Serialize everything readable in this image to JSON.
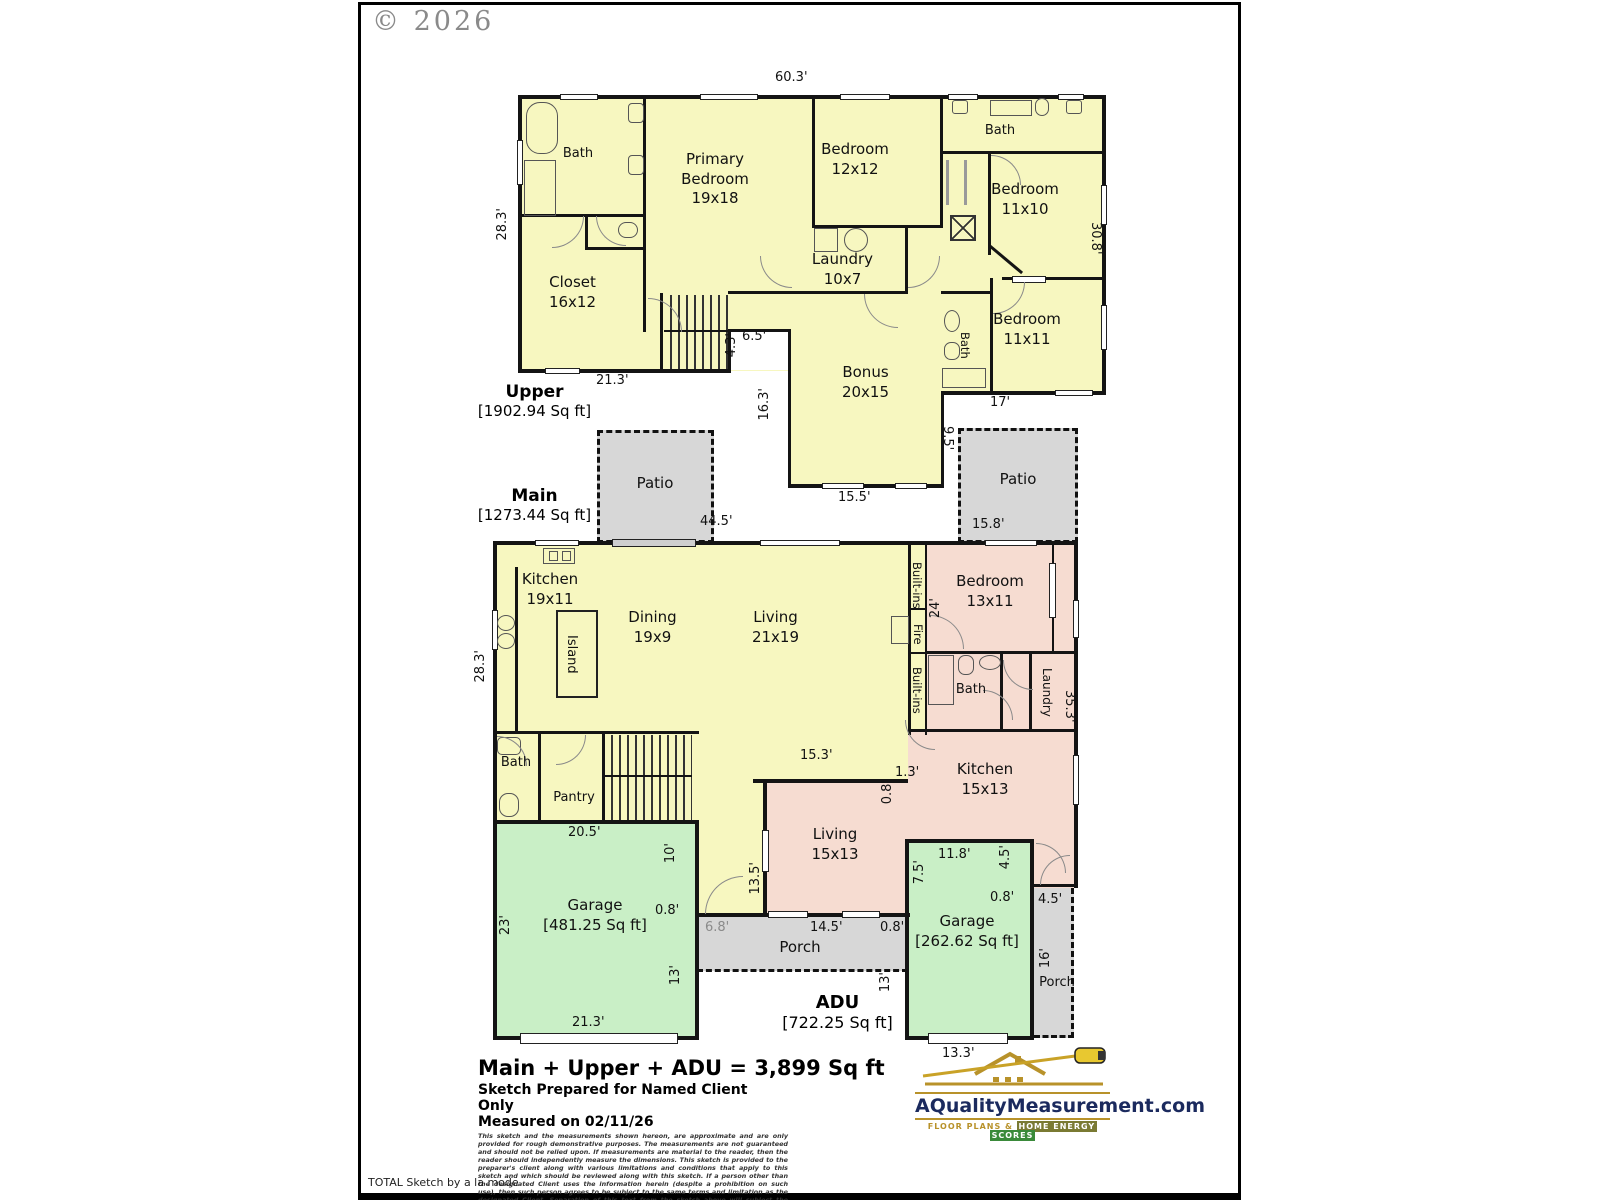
{
  "copyright": "© 2026",
  "footer_note": "TOTAL Sketch by a la mode",
  "floors": {
    "upper": {
      "name": "Upper",
      "sqft": "[1902.94 Sq ft]"
    },
    "main": {
      "name": "Main",
      "sqft": "[1273.44 Sq ft]"
    },
    "adu": {
      "name": "ADU",
      "sqft": "[722.25 Sq ft]"
    }
  },
  "summary": {
    "total": "Main + Upper + ADU = 3,899 Sq ft",
    "prepared": "Sketch Prepared for Named Client Only",
    "measured": "Measured on 02/11/26",
    "disclaimer": "This sketch and the measurements shown hereon, are approximate and are only provided for rough demonstrative purposes. The measurements are not guaranteed and should not be relied upon.  If measurements are material to the reader, then the reader should independently measure the dimensions.  This sketch is provided to the preparer's client along with various limitations and conditions that apply to this sketch and which should be reviewed along with this sketch.  If a person other than the designated Client uses the information herein (despite a prohibition on such use), then such person agrees to be subject to the same terms and limitation as the designated Client.  Separation of this text from the sketch above will subject the separating party to liability."
  },
  "branding": {
    "site": "AQualityMeasurement.com",
    "tagline_prefix": "Floor Plans &",
    "tagline_box1": "Home Energy",
    "tagline_box2": "Scores"
  },
  "rooms": {
    "upper_bath": "Bath",
    "primary_bedroom": "Primary\nBedroom\n19x18",
    "bedroom_12x12": "Bedroom\n12x12",
    "upper_bath2": "Bath",
    "bedroom_11x10": "Bedroom\n11x10",
    "closet": "Closet\n16x12",
    "laundry_upper": "Laundry\n10x7",
    "bedroom_11x11": "Bedroom\n11x11",
    "upper_bath3": "Bath",
    "bonus": "Bonus\n20x15",
    "patio_left": "Patio",
    "patio_right": "Patio",
    "kitchen_main": "Kitchen\n19x11",
    "island": "Island",
    "dining": "Dining\n19x9",
    "living_main": "Living\n21x19",
    "builtins_top": "Built-ins",
    "fire": "Fire",
    "builtins_bottom": "Built-ins",
    "bedroom_13x11": "Bedroom\n13x11",
    "bath_main": "Bath",
    "pantry": "Pantry",
    "bath_adu": "Bath",
    "laundry_adu": "Laundry",
    "kitchen_adu": "Kitchen\n15x13",
    "living_adu": "Living\n15x13",
    "porch_main": "Porch",
    "garage_main": "Garage\n[481.25 Sq ft]",
    "garage_adu": "Garage\n[262.62 Sq ft]",
    "porch_adu": "Porch"
  },
  "dims": {
    "u_top": "60.3'",
    "u_left": "28.3'",
    "u_right": "30.8'",
    "u_bottom_left": "21.3'",
    "u_notch_w": "6.5'",
    "u_notch_h": "4.3'",
    "u_bonus_left": "16.3'",
    "u_bonus_bottom": "15.5'",
    "u_right_bottom": "17'",
    "patio_r_h": "9.5'",
    "patio_r_w": "15.8'",
    "m_top": "44.5'",
    "m_left": "28.3'",
    "adu_bed_side": "24'",
    "adu_right": "35.3'",
    "m_wall_15_3": "15.3'",
    "adu_1_3": "1.3'",
    "adu_0_8": "0.8'",
    "liv_13_5": "13.5'",
    "gar_top": "20.5'",
    "gar_10": "10'",
    "gar_0_8": "0.8'",
    "porch_6_8": "6.8'",
    "porch_14_5": "14.5'",
    "porch_0_8": "0.8'",
    "gar_13": "13'",
    "adu_13": "13'",
    "gar_left": "23'",
    "gar_bottom": "21.3'",
    "g2_top": "11.8'",
    "g2_7_5": "7.5'",
    "g2_4_5a": "4.5'",
    "g2_0_8": "0.8'",
    "g2_4_5b": "4.5'",
    "porch2_16": "16'",
    "g2_bottom": "13.3'"
  }
}
